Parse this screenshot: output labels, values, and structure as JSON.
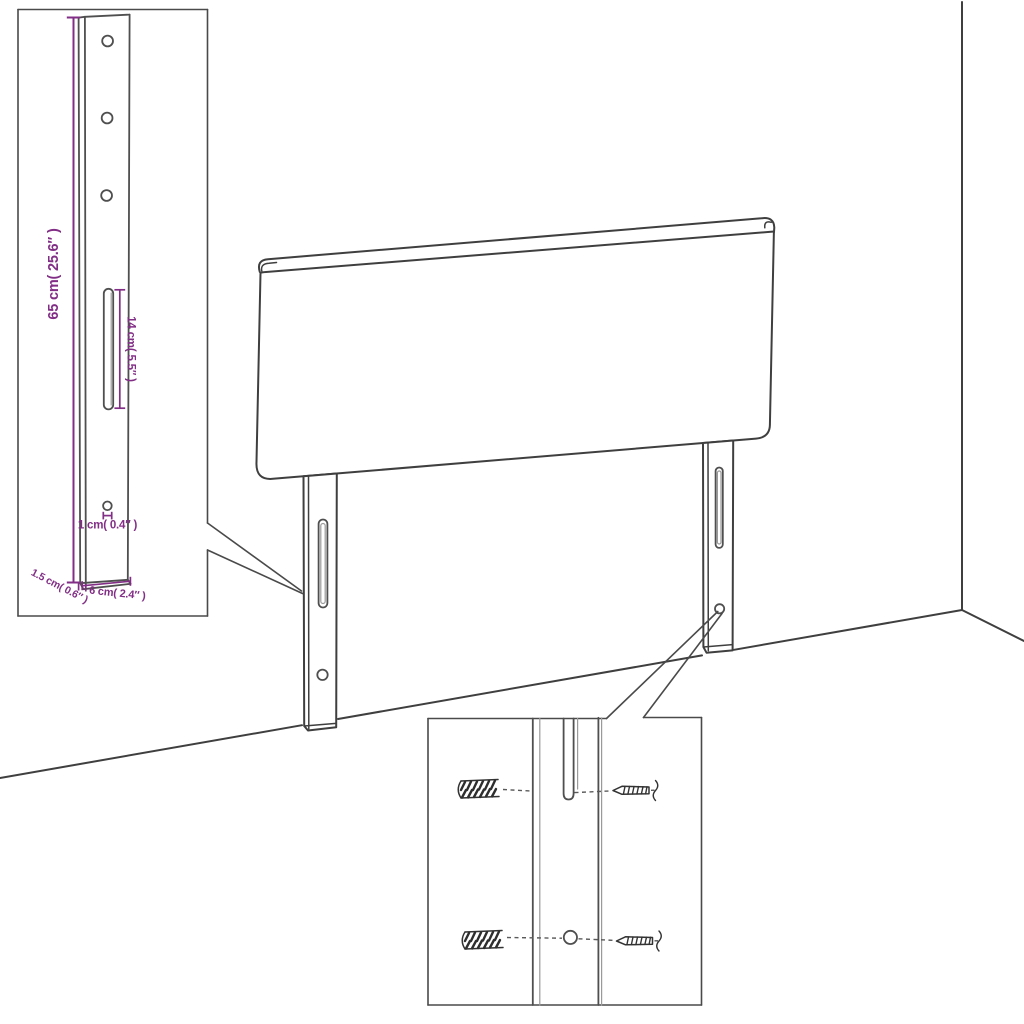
{
  "image": {
    "type": "product-assembly-diagram",
    "subject": "Upholstered headboard with two slotted mounting legs, leg-detail inset and wall-fixing hardware inset",
    "background_color": "#ffffff"
  },
  "colors": {
    "line": "#3f3f3f",
    "dimension": "#822e86"
  },
  "dimensions": {
    "leg_height": "65 cm( 25.6″ )",
    "slot_length": "14 cm( 5.5″ )",
    "hole_diameter": "1 cm( 0.4″ )",
    "leg_thickness": "1.5 cm( 0.6″ )",
    "leg_width": "6 cm( 2.4″ )"
  }
}
